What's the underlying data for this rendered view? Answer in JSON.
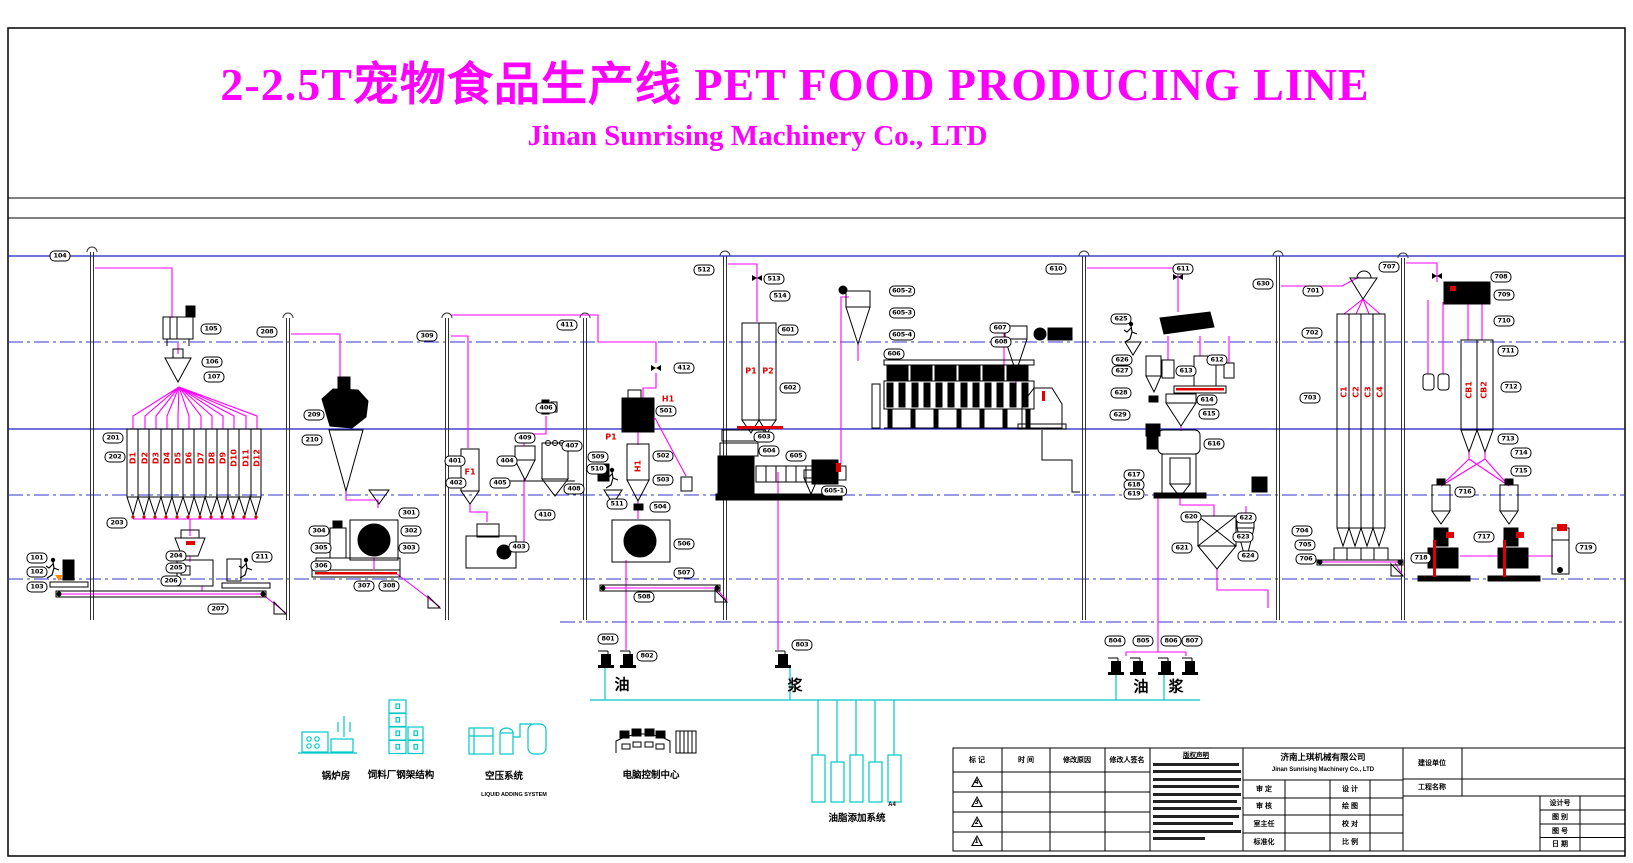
{
  "title": {
    "main": "2-2.5T宠物食品生产线 PET FOOD PRODUCING LINE",
    "sub": "Jinan Sunrising Machinery Co., LTD",
    "color": "#ff00ff"
  },
  "colors": {
    "flow": "#ff00ff",
    "utility": "#00c8c8",
    "floor_solid": "#1f1fbf",
    "floor_dash": "#3333cc",
    "alert": "#e10000"
  },
  "legend": {
    "items": [
      {
        "label": "锅炉房"
      },
      {
        "label": "饲料厂钢架结构"
      },
      {
        "label": "空压系统",
        "sublabel": "LIQUID ADDING SYSTEM"
      },
      {
        "label": "电脑控制中心"
      },
      {
        "label": "油脂添加系统"
      }
    ]
  },
  "flow_labels": [
    [
      "油",
      622,
      684
    ],
    [
      "浆",
      795,
      685
    ],
    [
      "油",
      1141,
      686
    ],
    [
      "浆",
      1176,
      686
    ]
  ],
  "equipment_labels": [
    [
      "101",
      37,
      558
    ],
    [
      "102",
      37,
      572
    ],
    [
      "103",
      37,
      587
    ],
    [
      "104",
      60,
      256
    ],
    [
      "105",
      211,
      329
    ],
    [
      "106",
      212,
      362
    ],
    [
      "107",
      214,
      377
    ],
    [
      "201",
      113,
      438
    ],
    [
      "202",
      115,
      457
    ],
    [
      "203",
      117,
      523
    ],
    [
      "204",
      176,
      556
    ],
    [
      "205",
      176,
      568
    ],
    [
      "206",
      171,
      581
    ],
    [
      "207",
      218,
      609
    ],
    [
      "208",
      267,
      332
    ],
    [
      "209",
      314,
      415
    ],
    [
      "210",
      312,
      440
    ],
    [
      "211",
      262,
      557
    ],
    [
      "301",
      409,
      513
    ],
    [
      "302",
      411,
      531
    ],
    [
      "303",
      409,
      548
    ],
    [
      "304",
      319,
      531
    ],
    [
      "305",
      321,
      548
    ],
    [
      "306",
      321,
      566
    ],
    [
      "307",
      364,
      586
    ],
    [
      "308",
      389,
      586
    ],
    [
      "309",
      427,
      336
    ],
    [
      "401",
      455,
      461
    ],
    [
      "402",
      456,
      483
    ],
    [
      "403",
      519,
      547
    ],
    [
      "404",
      507,
      461
    ],
    [
      "405",
      500,
      483
    ],
    [
      "406",
      546,
      408
    ],
    [
      "407",
      572,
      446
    ],
    [
      "408",
      574,
      489
    ],
    [
      "409",
      525,
      438
    ],
    [
      "410",
      545,
      515
    ],
    [
      "411",
      567,
      325
    ],
    [
      "412",
      684,
      368
    ],
    [
      "501",
      666,
      411
    ],
    [
      "502",
      663,
      456
    ],
    [
      "503",
      663,
      480
    ],
    [
      "504",
      660,
      507
    ],
    [
      "506",
      684,
      544
    ],
    [
      "507",
      684,
      573
    ],
    [
      "508",
      644,
      597
    ],
    [
      "509",
      598,
      457
    ],
    [
      "510",
      597,
      469
    ],
    [
      "511",
      617,
      504
    ],
    [
      "512",
      704,
      270
    ],
    [
      "513",
      774,
      279
    ],
    [
      "514",
      780,
      296
    ],
    [
      "601",
      788,
      330
    ],
    [
      "602",
      790,
      388
    ],
    [
      "603",
      764,
      437
    ],
    [
      "604",
      769,
      451
    ],
    [
      "605",
      796,
      456
    ],
    [
      "605-1",
      834,
      491
    ],
    [
      "605-2",
      902,
      291
    ],
    [
      "605-3",
      902,
      313
    ],
    [
      "605-4",
      902,
      335
    ],
    [
      "606",
      894,
      354
    ],
    [
      "607",
      1000,
      328
    ],
    [
      "608",
      1001,
      342
    ],
    [
      "610",
      1056,
      269
    ],
    [
      "611",
      1183,
      269
    ],
    [
      "612",
      1217,
      360
    ],
    [
      "613",
      1186,
      371
    ],
    [
      "614",
      1207,
      400
    ],
    [
      "615",
      1209,
      414
    ],
    [
      "616",
      1214,
      444
    ],
    [
      "617",
      1134,
      475
    ],
    [
      "618",
      1134,
      485
    ],
    [
      "619",
      1134,
      494
    ],
    [
      "620",
      1191,
      517
    ],
    [
      "621",
      1182,
      548
    ],
    [
      "622",
      1246,
      518
    ],
    [
      "623",
      1243,
      537
    ],
    [
      "624",
      1248,
      556
    ],
    [
      "625",
      1121,
      319
    ],
    [
      "626",
      1122,
      360
    ],
    [
      "627",
      1122,
      371
    ],
    [
      "628",
      1121,
      393
    ],
    [
      "629",
      1120,
      415
    ],
    [
      "630",
      1263,
      284
    ],
    [
      "701",
      1313,
      291
    ],
    [
      "702",
      1312,
      333
    ],
    [
      "703",
      1310,
      398
    ],
    [
      "704",
      1302,
      531
    ],
    [
      "705",
      1305,
      545
    ],
    [
      "706",
      1306,
      559
    ],
    [
      "707",
      1389,
      267
    ],
    [
      "708",
      1501,
      277
    ],
    [
      "709",
      1504,
      295
    ],
    [
      "710",
      1504,
      321
    ],
    [
      "711",
      1508,
      351
    ],
    [
      "712",
      1511,
      387
    ],
    [
      "713",
      1508,
      439
    ],
    [
      "714",
      1521,
      453
    ],
    [
      "715",
      1521,
      471
    ],
    [
      "716",
      1465,
      492
    ],
    [
      "717",
      1484,
      537
    ],
    [
      "718",
      1421,
      558
    ],
    [
      "719",
      1586,
      548
    ],
    [
      "801",
      608,
      639
    ],
    [
      "802",
      647,
      656
    ],
    [
      "803",
      802,
      645
    ],
    [
      "804",
      1115,
      641
    ],
    [
      "805",
      1143,
      641
    ],
    [
      "806",
      1171,
      641
    ],
    [
      "807",
      1192,
      641
    ]
  ],
  "red_labels": [
    [
      "D1",
      133,
      458,
      "v"
    ],
    [
      "D2",
      145,
      458,
      "v"
    ],
    [
      "D3",
      156,
      458,
      "v"
    ],
    [
      "D4",
      167,
      458,
      "v"
    ],
    [
      "D5",
      178,
      458,
      "v"
    ],
    [
      "D6",
      189,
      458,
      "v"
    ],
    [
      "D7",
      201,
      458,
      "v"
    ],
    [
      "D8",
      212,
      458,
      "v"
    ],
    [
      "D9",
      223,
      458,
      "v"
    ],
    [
      "D10",
      234,
      458,
      "v"
    ],
    [
      "D11",
      246,
      458,
      "v"
    ],
    [
      "D12",
      257,
      458,
      "v"
    ],
    [
      "F1",
      470,
      472,
      "h"
    ],
    [
      "P1",
      611,
      437,
      "h"
    ],
    [
      "H1",
      668,
      399,
      "h"
    ],
    [
      "H1",
      638,
      466,
      "v"
    ],
    [
      "P1",
      751,
      371,
      "h"
    ],
    [
      "P2",
      768,
      371,
      "h"
    ],
    [
      "C1",
      1344,
      392,
      "v"
    ],
    [
      "C2",
      1356,
      392,
      "v"
    ],
    [
      "C3",
      1368,
      392,
      "v"
    ],
    [
      "C4",
      1380,
      392,
      "v"
    ],
    [
      "CB1",
      1469,
      390,
      "v"
    ],
    [
      "CB2",
      1484,
      390,
      "v"
    ]
  ],
  "structure": {
    "black_lines": [
      198,
      218
    ],
    "floors_solid": [
      256,
      429
    ],
    "floors_dash": [
      342,
      495,
      579
    ],
    "floors_dash_partial": [
      {
        "y": 622,
        "x1": 560,
        "x2": 1625
      }
    ],
    "columns": [
      {
        "x": 92,
        "top": 252
      },
      {
        "x": 288,
        "top": 318
      },
      {
        "x": 447,
        "top": 318
      },
      {
        "x": 585,
        "top": 318
      },
      {
        "x": 725,
        "top": 256
      },
      {
        "x": 1084,
        "top": 256
      },
      {
        "x": 1278,
        "top": 256
      },
      {
        "x": 1403,
        "top": 258
      }
    ]
  },
  "titleblock": {
    "rev_headers": [
      "标 记",
      "时 间",
      "修改原因",
      "修改人签名"
    ],
    "rev_marks": [
      "4",
      "3",
      "2",
      "1"
    ],
    "notice_title": "版权声明",
    "company_cn": "济南上琪机械有限公司",
    "company_en": "Jinan Sunrising Machinery Co., LTD",
    "sign_rows": [
      [
        "审 定",
        "设 计"
      ],
      [
        "审 核",
        "绘 图"
      ],
      [
        "室主任",
        "校 对"
      ],
      [
        "标准化",
        "比 例"
      ]
    ],
    "build_label": "建设单位",
    "project_label": "工程名称",
    "doc_rows": [
      "设计号",
      "图 别",
      "图 号",
      "日 期"
    ],
    "paper": "A4"
  }
}
